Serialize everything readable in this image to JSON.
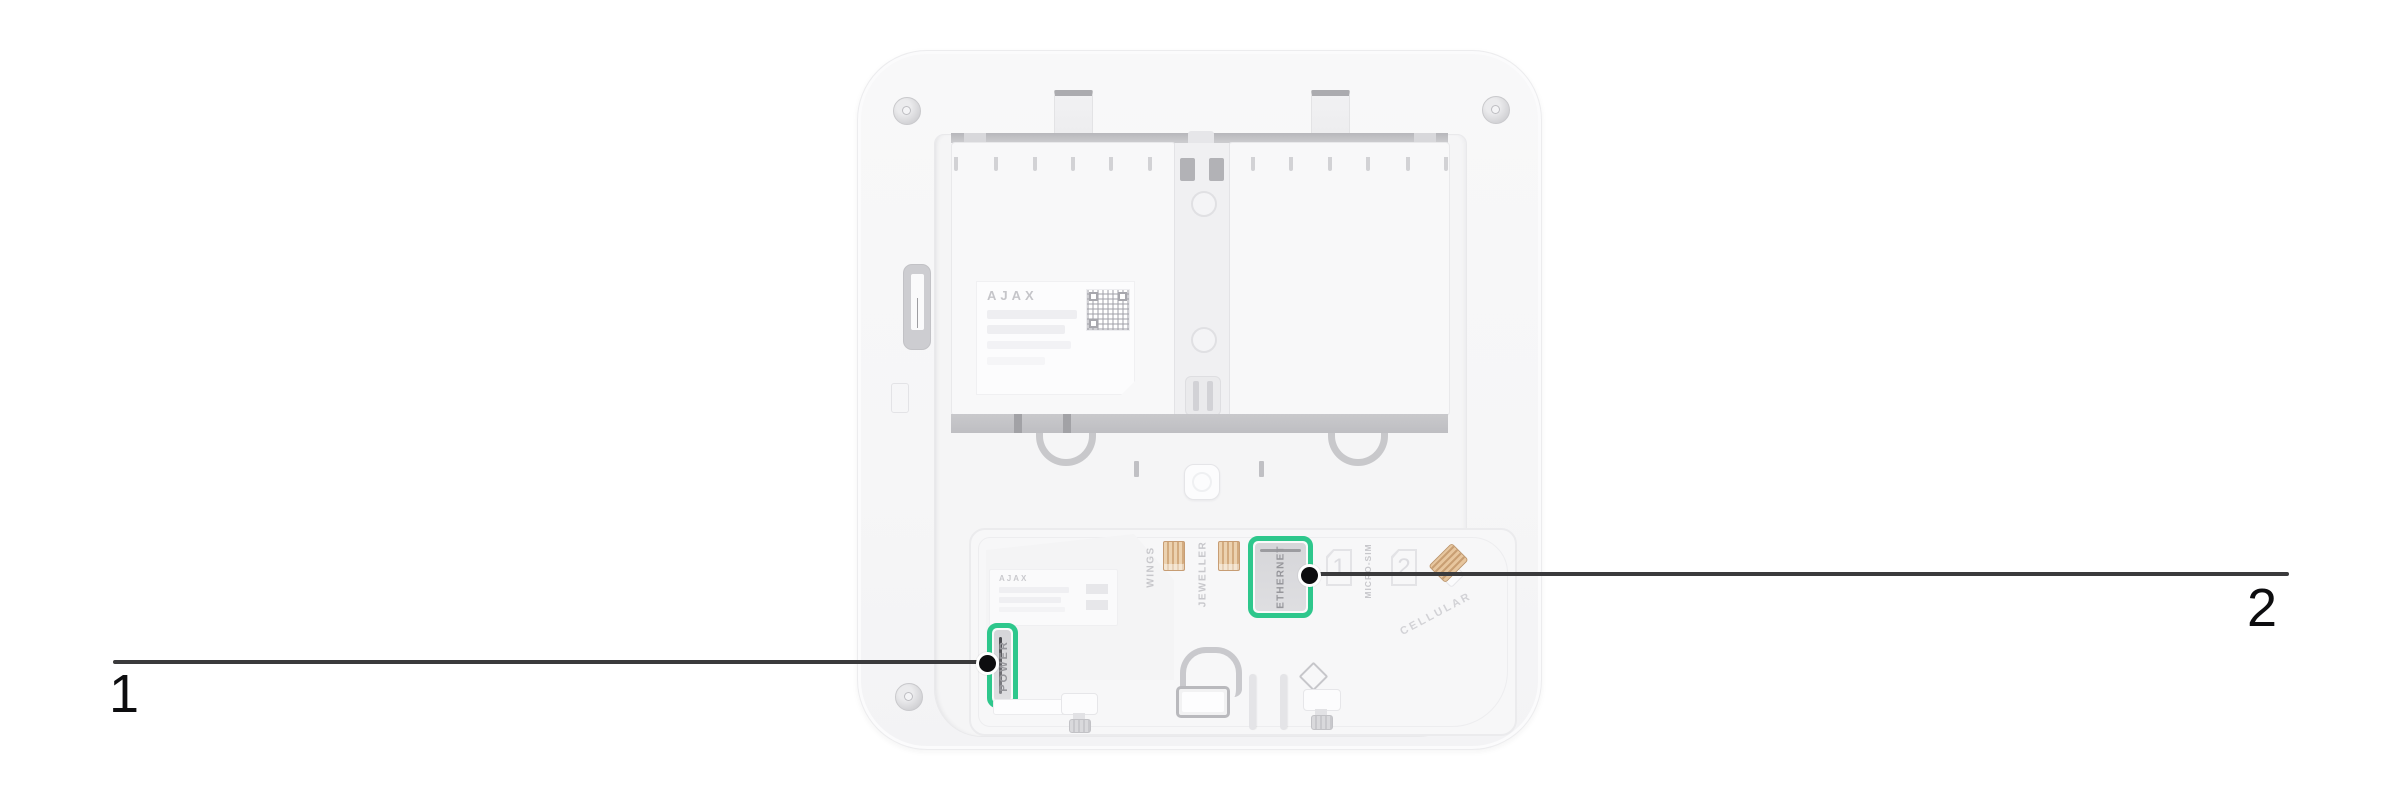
{
  "figure": {
    "type": "device-rear-diagram",
    "background": "#ffffff"
  },
  "colors": {
    "highlight_green": "#2ec78c",
    "callout_line": "#3a3a3c",
    "callout_dot": "#0d0d0f",
    "device_body": "#f7f7f8",
    "connector_tan": "#d3ab7f"
  },
  "device": {
    "brand": "AJAX",
    "pcb_brand": "AJAX",
    "port_labels": {
      "power": "POWER",
      "ethernet": "ETHERNET",
      "wings": "WINGS",
      "jeweller": "JEWELLER"
    },
    "sim_labels": {
      "micro_sim": "MICRO-SIM",
      "slot1": "1",
      "slot2": "2",
      "cellular": "CELLULAR"
    }
  },
  "callouts": [
    {
      "number": "1",
      "points_to": "POWER connector"
    },
    {
      "number": "2",
      "points_to": "ETHERNET connector"
    }
  ]
}
